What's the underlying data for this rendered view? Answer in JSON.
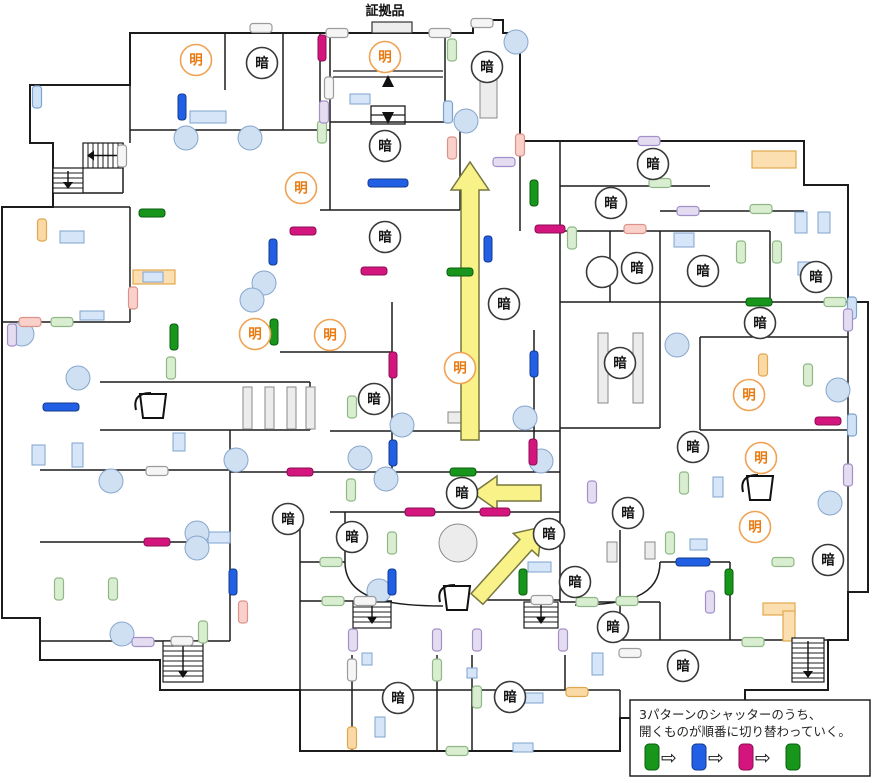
{
  "evidence": {
    "label": "証拠品"
  },
  "legend": {
    "line1": "3パターンのシャッターのうち、",
    "line2": "開くものが順番に切り替わっていく。",
    "sequence": [
      "green",
      "blue",
      "pink",
      "green"
    ],
    "arrow_glyph": "⇨"
  },
  "labels": {
    "bright": "明",
    "dark": "暗"
  },
  "colors": {
    "wall": "#1c1c1c",
    "green": "#18961c",
    "green_edge": "#0a5c0e",
    "blue": "#2160e4",
    "blue_edge": "#123a8c",
    "pink": "#d4157e",
    "pink_edge": "#8c0e54",
    "bright_stroke": "#f0a355",
    "bright_text": "#e87a12",
    "dark_stroke": "#3a3a3a",
    "dark_text": "#141414",
    "arrow_fill": "#f9f289",
    "arrow_stroke": "#77773f",
    "column_fill": "#cfe0f3",
    "column_stroke": "#88a6cc",
    "furniture_fill": "#d6e5f7",
    "furniture_stroke": "#7fa3cf",
    "shelf_fill": "#ececec",
    "shelf_stroke": "#8a8a8a",
    "highlight_fill": "#fcdfb0",
    "highlight_stroke": "#e2a84e",
    "door_lb_fill": "#cfe2f6",
    "door_lb_edge": "#7fa3cf",
    "door_lg_fill": "#d9edd0",
    "door_lg_edge": "#8fb886",
    "door_lv_fill": "#e4dcf0",
    "door_lv_edge": "#a291c8",
    "door_sa_fill": "#f9d0ca",
    "door_sa_edge": "#dc9289",
    "door_or_fill": "#fbd9a4",
    "door_or_edge": "#dfa750",
    "door_wh_fill": "#f5f5f5",
    "door_wh_edge": "#9b9b9b"
  },
  "map": {
    "outline": "M130,33 L473,33 L473,20 L503,20 L503,33 L520,33 L520,141 L804,141 L804,185 L848,185 L848,302 L868,302 L868,592 L848,592 L848,640 L828,640 L828,690 L745,690 L745,718 L620,718 L620,751 L300,751 L300,690 L160,690 L160,660 L40,660 L40,618 L2,618 L2,207 L53,207 L53,143 L30,143 L30,85 L130,85 Z",
    "segments": [
      [
        130,
        130,
        330,
        130
      ],
      [
        53,
        193,
        123,
        193
      ],
      [
        123,
        143,
        123,
        193
      ],
      [
        53,
        207,
        130,
        207
      ],
      [
        320,
        210,
        460,
        210
      ],
      [
        560,
        186,
        710,
        186
      ],
      [
        660,
        211,
        804,
        211
      ],
      [
        560,
        231,
        770,
        231
      ],
      [
        560,
        302,
        848,
        302
      ],
      [
        2,
        322,
        130,
        322
      ],
      [
        100,
        382,
        310,
        382
      ],
      [
        280,
        352,
        392,
        352
      ],
      [
        40,
        470,
        230,
        470
      ],
      [
        230,
        472,
        560,
        472
      ],
      [
        330,
        512,
        560,
        512
      ],
      [
        40,
        542,
        230,
        542
      ],
      [
        300,
        562,
        345,
        562
      ],
      [
        660,
        562,
        730,
        562
      ],
      [
        560,
        602,
        660,
        602
      ],
      [
        300,
        601,
        392,
        601
      ],
      [
        480,
        600,
        560,
        600
      ],
      [
        40,
        641,
        230,
        641
      ],
      [
        300,
        690,
        620,
        690
      ],
      [
        620,
        640,
        828,
        640
      ],
      [
        330,
        122,
        445,
        122
      ],
      [
        560,
        428,
        660,
        428
      ],
      [
        700,
        430,
        848,
        430
      ],
      [
        700,
        337,
        848,
        337
      ],
      [
        330,
        431,
        560,
        431
      ],
      [
        100,
        430,
        310,
        430
      ],
      [
        130,
        85,
        130,
        143
      ],
      [
        225,
        33,
        225,
        90
      ],
      [
        283,
        33,
        283,
        130
      ],
      [
        320,
        33,
        320,
        130
      ],
      [
        330,
        32,
        330,
        210
      ],
      [
        445,
        33,
        445,
        122
      ],
      [
        460,
        130,
        460,
        210
      ],
      [
        520,
        141,
        520,
        231
      ],
      [
        560,
        141,
        560,
        602
      ],
      [
        610,
        231,
        610,
        302
      ],
      [
        660,
        231,
        660,
        302
      ],
      [
        770,
        231,
        770,
        302
      ],
      [
        660,
        302,
        660,
        428
      ],
      [
        700,
        337,
        700,
        430
      ],
      [
        620,
        530,
        620,
        640
      ],
      [
        352,
        655,
        352,
        751
      ],
      [
        437,
        655,
        437,
        751
      ],
      [
        472,
        655,
        472,
        751
      ],
      [
        565,
        655,
        565,
        690
      ],
      [
        392,
        302,
        392,
        472
      ],
      [
        534,
        330,
        534,
        472
      ],
      [
        345,
        512,
        345,
        562
      ],
      [
        310,
        382,
        310,
        430
      ],
      [
        230,
        430,
        230,
        641
      ],
      [
        130,
        207,
        130,
        322
      ],
      [
        300,
        512,
        300,
        690
      ],
      [
        620,
        690,
        620,
        718
      ],
      [
        730,
        562,
        730,
        640
      ],
      [
        848,
        302,
        848,
        592
      ],
      [
        660,
        602,
        660,
        640
      ]
    ],
    "curves": [
      "M345,562 C345,598 385,606 443,606",
      "M660,562 C660,596 628,605 575,605"
    ],
    "escalator": {
      "lines": [
        [
          333,
          71,
          443,
          71
        ],
        [
          333,
          77,
          443,
          77
        ],
        [
          371,
          115,
          405,
          115
        ]
      ],
      "box": [
        371,
        106,
        34,
        18
      ],
      "up_xy": [
        388,
        82
      ],
      "down_xy": [
        388,
        118
      ]
    },
    "shutters": {
      "green": [
        [
          152,
          213,
          "h"
        ],
        [
          534,
          193,
          "v"
        ],
        [
          460,
          272,
          "h"
        ],
        [
          174,
          337,
          "v"
        ],
        [
          274,
          332,
          "v"
        ],
        [
          463,
          472,
          "h"
        ],
        [
          523,
          582,
          "v"
        ],
        [
          729,
          582,
          "v"
        ],
        [
          759,
          302,
          "h"
        ]
      ],
      "blue": [
        [
          182,
          107,
          "v"
        ],
        [
          388,
          183,
          "h",
          40
        ],
        [
          488,
          249,
          "v"
        ],
        [
          273,
          252,
          "v"
        ],
        [
          61,
          407,
          "h",
          36
        ],
        [
          393,
          453,
          "v"
        ],
        [
          534,
          364,
          "v"
        ],
        [
          233,
          582,
          "v"
        ],
        [
          392,
          582,
          "v"
        ],
        [
          693,
          562,
          "h",
          34
        ]
      ],
      "pink": [
        [
          322,
          48,
          "v"
        ],
        [
          303,
          231,
          "h"
        ],
        [
          374,
          271,
          "h"
        ],
        [
          550,
          229,
          "h",
          30
        ],
        [
          393,
          365,
          "v"
        ],
        [
          533,
          452,
          "v"
        ],
        [
          300,
          472,
          "h"
        ],
        [
          420,
          512,
          "h",
          30
        ],
        [
          495,
          512,
          "h",
          30
        ],
        [
          157,
          542,
          "h"
        ],
        [
          828,
          421,
          "h"
        ]
      ]
    },
    "doors": [
      [
        "lb",
        "v",
        37,
        97
      ],
      [
        "lb",
        "v",
        448,
        112
      ],
      [
        "lb",
        "v",
        852,
        308
      ],
      [
        "lb",
        "v",
        852,
        425
      ],
      [
        "lg",
        "v",
        452,
        50
      ],
      [
        "lg",
        "v",
        322,
        132
      ],
      [
        "lg",
        "h",
        660,
        183
      ],
      [
        "lg",
        "h",
        761,
        209
      ],
      [
        "lg",
        "v",
        741,
        252
      ],
      [
        "lg",
        "v",
        777,
        252
      ],
      [
        "lg",
        "h",
        835,
        302
      ],
      [
        "lg",
        "h",
        62,
        322
      ],
      [
        "lg",
        "v",
        171,
        368
      ],
      [
        "lg",
        "v",
        352,
        407
      ],
      [
        "lg",
        "v",
        351,
        490
      ],
      [
        "lg",
        "v",
        59,
        589
      ],
      [
        "lg",
        "v",
        113,
        589
      ],
      [
        "lg",
        "v",
        392,
        543
      ],
      [
        "lg",
        "h",
        331,
        562
      ],
      [
        "lg",
        "h",
        333,
        601
      ],
      [
        "lg",
        "v",
        437,
        670
      ],
      [
        "lg",
        "v",
        477,
        697
      ],
      [
        "lg",
        "h",
        457,
        751
      ],
      [
        "lg",
        "h",
        587,
        602
      ],
      [
        "lg",
        "h",
        627,
        601
      ],
      [
        "lg",
        "h",
        753,
        642
      ],
      [
        "lg",
        "h",
        783,
        562
      ],
      [
        "lg",
        "v",
        670,
        543
      ],
      [
        "lg",
        "v",
        808,
        375
      ],
      [
        "lg",
        "v",
        684,
        483
      ],
      [
        "lg",
        "v",
        572,
        238
      ],
      [
        "lg",
        "v",
        203,
        632
      ],
      [
        "lv",
        "v",
        324,
        112
      ],
      [
        "lv",
        "h",
        649,
        141
      ],
      [
        "lv",
        "h",
        688,
        211
      ],
      [
        "lv",
        "h",
        504,
        162
      ],
      [
        "lv",
        "v",
        12,
        335
      ],
      [
        "lv",
        "h",
        143,
        642
      ],
      [
        "lv",
        "v",
        353,
        640
      ],
      [
        "lv",
        "v",
        437,
        640
      ],
      [
        "lv",
        "v",
        477,
        640
      ],
      [
        "lv",
        "v",
        563,
        640
      ],
      [
        "lv",
        "v",
        710,
        602
      ],
      [
        "lv",
        "v",
        592,
        492
      ],
      [
        "lv",
        "v",
        848,
        320
      ],
      [
        "lv",
        "v",
        848,
        475
      ],
      [
        "sa",
        "v",
        452,
        148
      ],
      [
        "sa",
        "h",
        635,
        229
      ],
      [
        "sa",
        "h",
        30,
        322
      ],
      [
        "sa",
        "v",
        133,
        298
      ],
      [
        "sa",
        "v",
        243,
        612
      ],
      [
        "sa",
        "v",
        520,
        145
      ],
      [
        "or",
        "v",
        42,
        230
      ],
      [
        "or",
        "v",
        763,
        365
      ],
      [
        "or",
        "v",
        352,
        738
      ],
      [
        "or",
        "h",
        577,
        692
      ],
      [
        "wh",
        "h",
        337,
        33
      ],
      [
        "wh",
        "h",
        440,
        33
      ],
      [
        "wh",
        "h",
        482,
        23
      ],
      [
        "wh",
        "v",
        329,
        88
      ],
      [
        "wh",
        "h",
        261,
        28
      ],
      [
        "wh",
        "h",
        157,
        471
      ],
      [
        "wh",
        "h",
        182,
        641
      ],
      [
        "wh",
        "h",
        365,
        601
      ],
      [
        "wh",
        "h",
        542,
        600
      ],
      [
        "wh",
        "h",
        630,
        653
      ],
      [
        "wh",
        "v",
        352,
        670
      ],
      [
        "wh",
        "v",
        122,
        156
      ]
    ],
    "circles": {
      "bright": [
        [
          196,
          60
        ],
        [
          385,
          57
        ],
        [
          301,
          188
        ],
        [
          255,
          334
        ],
        [
          330,
          335
        ],
        [
          460,
          368
        ],
        [
          749,
          395
        ],
        [
          761,
          458
        ],
        [
          755,
          527
        ]
      ],
      "dark": [
        [
          262,
          63
        ],
        [
          487,
          67
        ],
        [
          385,
          146
        ],
        [
          385,
          237
        ],
        [
          504,
          304
        ],
        [
          653,
          164
        ],
        [
          611,
          203
        ],
        [
          637,
          268
        ],
        [
          703,
          271
        ],
        [
          816,
          277
        ],
        [
          760,
          323
        ],
        [
          620,
          363
        ],
        [
          374,
          399
        ],
        [
          693,
          447
        ],
        [
          462,
          493
        ],
        [
          288,
          519
        ],
        [
          628,
          513
        ],
        [
          352,
          537
        ],
        [
          549,
          534
        ],
        [
          575,
          582
        ],
        [
          828,
          560
        ],
        [
          613,
          627
        ],
        [
          683,
          666
        ],
        [
          398,
          698
        ],
        [
          510,
          697
        ]
      ],
      "plain": [
        [
          602,
          272
        ]
      ]
    },
    "arrows": [
      {
        "x": 470,
        "y": 440,
        "angle": -90,
        "len": 278,
        "shaft": 9,
        "headL": 28,
        "headW": 19
      },
      {
        "x": 541,
        "y": 493,
        "angle": 180,
        "len": 68,
        "shaft": 8,
        "headL": 24,
        "headW": 17
      },
      {
        "x": 477,
        "y": 599,
        "angle": -48,
        "len": 97,
        "shaft": 8,
        "headL": 24,
        "headW": 17
      }
    ],
    "stairs": [
      {
        "x": 83,
        "y": 143,
        "w": 40,
        "h": 25,
        "dir": "left"
      },
      {
        "x": 53,
        "y": 168,
        "w": 30,
        "h": 25,
        "dir": "down"
      },
      {
        "x": 353,
        "y": 602,
        "w": 38,
        "h": 26,
        "dir": "down"
      },
      {
        "x": 524,
        "y": 602,
        "w": 34,
        "h": 26,
        "dir": "down"
      },
      {
        "x": 163,
        "y": 641,
        "w": 40,
        "h": 41,
        "dir": "down"
      },
      {
        "x": 792,
        "y": 638,
        "w": 32,
        "h": 44,
        "dir": "down"
      }
    ],
    "columns": [
      [
        466,
        121
      ],
      [
        516,
        42
      ],
      [
        186,
        138
      ],
      [
        250,
        138
      ],
      [
        22,
        334
      ],
      [
        78,
        378
      ],
      [
        264,
        283
      ],
      [
        252,
        300
      ],
      [
        402,
        425
      ],
      [
        360,
        458
      ],
      [
        386,
        479
      ],
      [
        111,
        481
      ],
      [
        197,
        533
      ],
      [
        197,
        548
      ],
      [
        236,
        460
      ],
      [
        379,
        591
      ],
      [
        122,
        634
      ],
      [
        677,
        345
      ],
      [
        838,
        390
      ],
      [
        830,
        503
      ],
      [
        525,
        418
      ],
      [
        541,
        461
      ]
    ],
    "furniture": [
      [
        350,
        94,
        20,
        10
      ],
      [
        190,
        111,
        36,
        12
      ],
      [
        60,
        231,
        24,
        12
      ],
      [
        143,
        272,
        20,
        10
      ],
      [
        80,
        311,
        24,
        9
      ],
      [
        795,
        212,
        12,
        21
      ],
      [
        818,
        212,
        12,
        21
      ],
      [
        798,
        262,
        20,
        13
      ],
      [
        32,
        445,
        13,
        20
      ],
      [
        72,
        443,
        11,
        24
      ],
      [
        173,
        433,
        12,
        18
      ],
      [
        208,
        532,
        22,
        11
      ],
      [
        528,
        562,
        23,
        10
      ],
      [
        713,
        477,
        10,
        20
      ],
      [
        690,
        539,
        17,
        11
      ],
      [
        674,
        233,
        20,
        14
      ],
      [
        362,
        653,
        10,
        12
      ],
      [
        467,
        668,
        10,
        10
      ],
      [
        525,
        693,
        18,
        10
      ],
      [
        513,
        743,
        20,
        9
      ],
      [
        375,
        717,
        10,
        20
      ],
      [
        592,
        653,
        11,
        22
      ]
    ],
    "shelves": [
      [
        480,
        80,
        17,
        38
      ],
      [
        598,
        333,
        10,
        70
      ],
      [
        633,
        333,
        10,
        70
      ],
      [
        243,
        387,
        9,
        42
      ],
      [
        265,
        387,
        9,
        42
      ],
      [
        287,
        387,
        9,
        42
      ],
      [
        306,
        387,
        9,
        42
      ],
      [
        448,
        412,
        20,
        11
      ],
      [
        607,
        542,
        10,
        20
      ],
      [
        645,
        542,
        10,
        17
      ]
    ],
    "gray_circles": [
      [
        458,
        543,
        19
      ]
    ],
    "buckets": [
      [
        153,
        405
      ],
      [
        457,
        597
      ],
      [
        760,
        487
      ]
    ],
    "highlights": [
      [
        133,
        270,
        42,
        14
      ],
      [
        752,
        151,
        44,
        17
      ],
      [
        763,
        603,
        32,
        12
      ],
      [
        783,
        611,
        12,
        30
      ]
    ],
    "evidence_box": [
      372,
      22,
      40,
      11
    ]
  }
}
